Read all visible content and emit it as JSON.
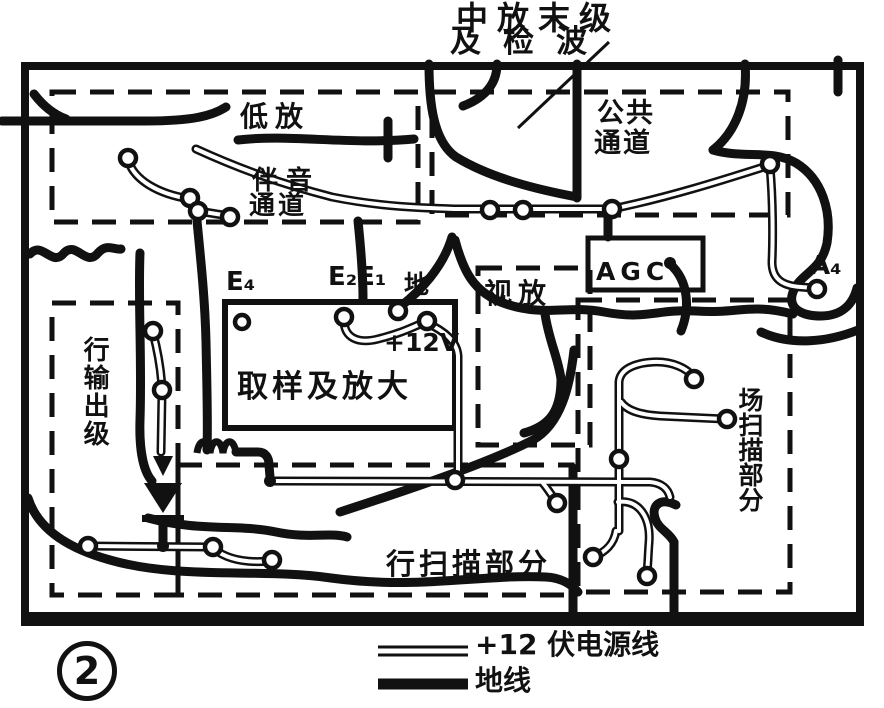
{
  "figure": {
    "number": "2"
  },
  "annotations": {
    "top_line1": "中放末级",
    "top_line2": "及检波"
  },
  "regions": {
    "low_amp": "低放",
    "sound_channel_line1": "伴音",
    "sound_channel_line2": "通道",
    "common_channel_line1": "公共",
    "common_channel_line2": "通道",
    "sample_amp": "取样及放大",
    "video_amp": "视放",
    "agc": "AGC",
    "horiz_output": "行输出级",
    "field_scan": "场扫描部分",
    "horiz_scan": "行扫描部分"
  },
  "pads": {
    "e4": "E₄",
    "e2e1": "E₂E₁",
    "ground": "地",
    "plus12v": "+12V",
    "a4": "A₄"
  },
  "legend": {
    "power": "+12 伏电源线",
    "ground": "地线"
  },
  "colors": {
    "ink": "#111111",
    "paper": "#ffffff"
  }
}
